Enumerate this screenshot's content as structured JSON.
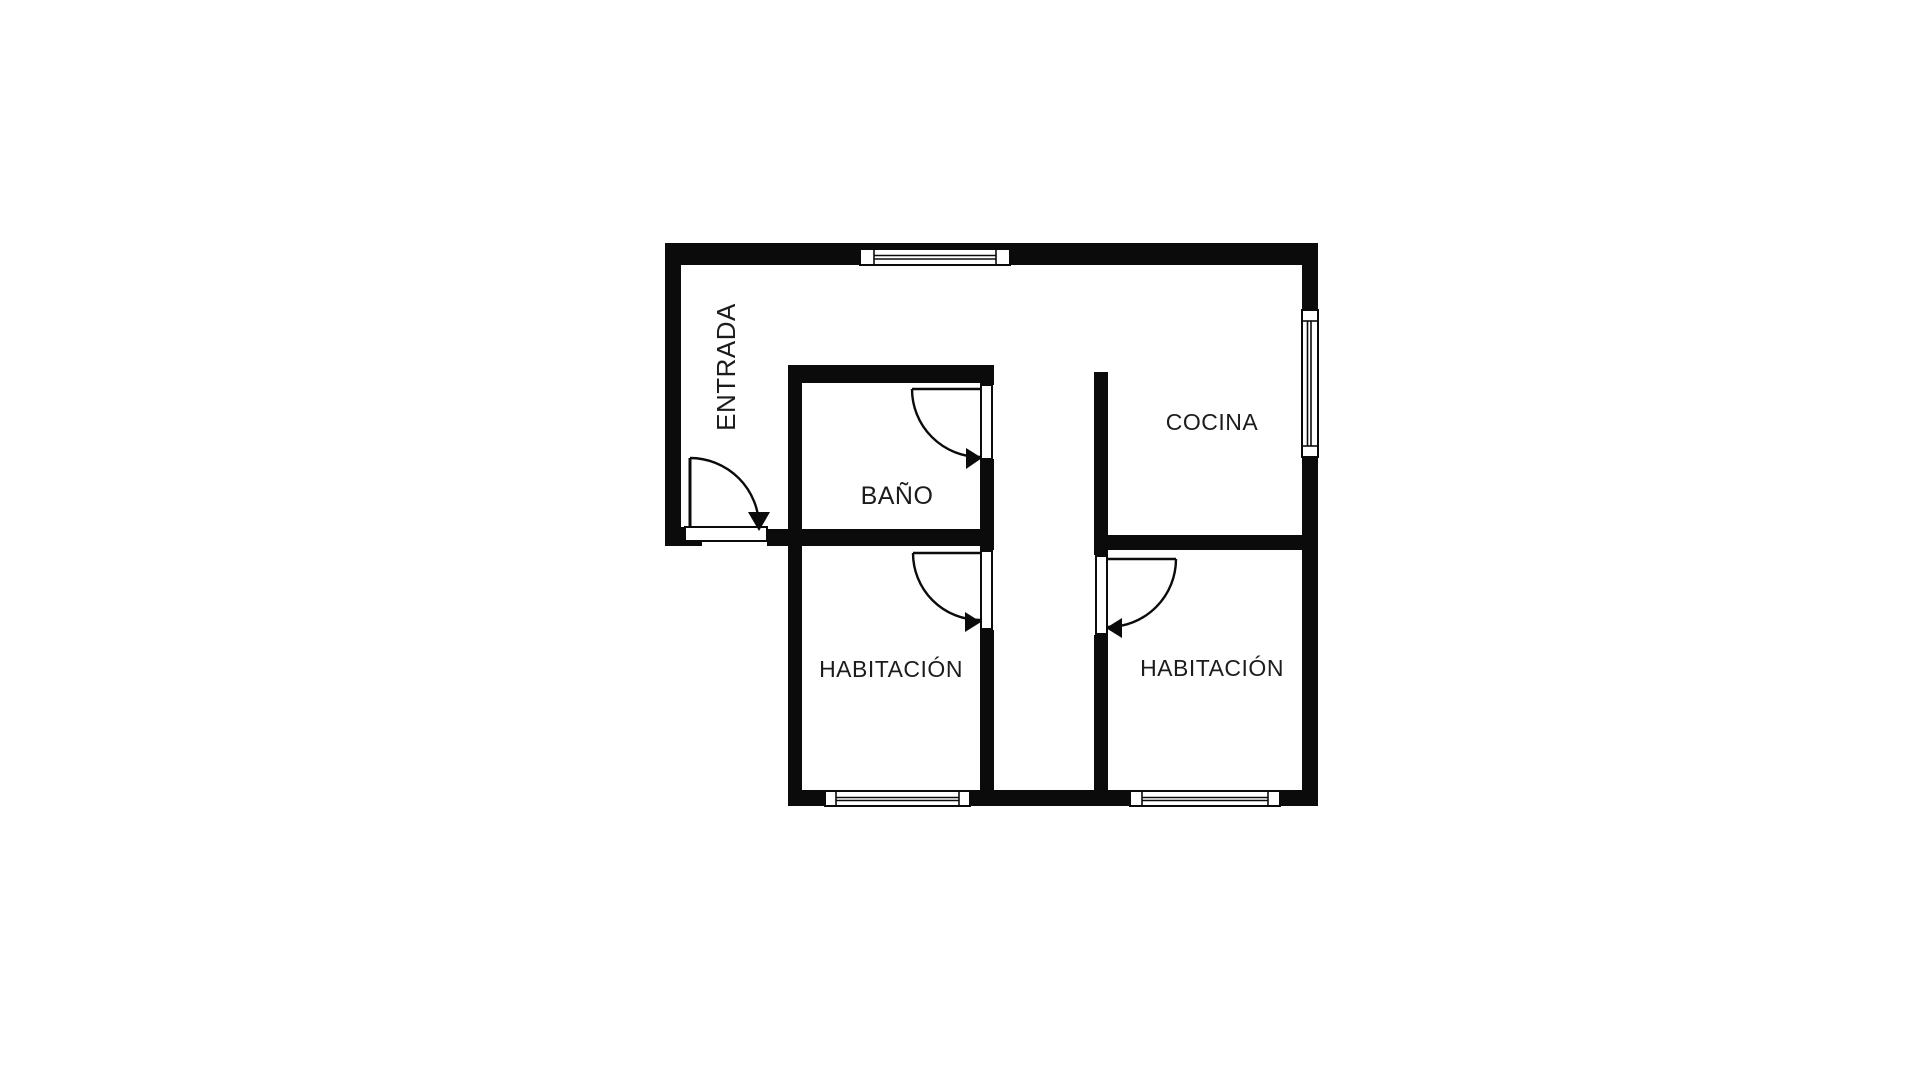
{
  "colors": {
    "background": "#ffffff",
    "wall": "#0b0b0b",
    "text": "#1c1c1c"
  },
  "plan": {
    "type": "apartment-floor-plan",
    "rooms": [
      {
        "id": "entrada",
        "label": "ENTRADA",
        "label_orientation": "vertical-bottom-to-top"
      },
      {
        "id": "bano",
        "label": "BAÑO",
        "label_orientation": "horizontal"
      },
      {
        "id": "cocina",
        "label": "COCINA",
        "label_orientation": "horizontal"
      },
      {
        "id": "habitacion-izquierda",
        "label": "HABITACIÓN",
        "label_orientation": "horizontal"
      },
      {
        "id": "habitacion-derecha",
        "label": "HABITACIÓN",
        "label_orientation": "horizontal"
      }
    ],
    "doors": [
      {
        "id": "entry-door",
        "room": "entrada",
        "swing": "down-right",
        "location": "bottom of left wall"
      },
      {
        "id": "bano-door",
        "room": "bano",
        "swing": "down-right",
        "location": "upper part of right wall"
      },
      {
        "id": "habitacion-izquierda-door",
        "room": "habitacion-izquierda",
        "swing": "down-right",
        "location": "top of right wall"
      },
      {
        "id": "habitacion-derecha-door",
        "room": "habitacion-derecha",
        "swing": "down-left",
        "location": "top of left wall"
      }
    ],
    "windows": [
      {
        "id": "window-top",
        "location": "top wall"
      },
      {
        "id": "window-right",
        "location": "right wall of cocina"
      },
      {
        "id": "window-bottom-left",
        "location": "bottom wall of left habitación"
      },
      {
        "id": "window-bottom-right",
        "location": "bottom wall of right habitación"
      }
    ]
  }
}
